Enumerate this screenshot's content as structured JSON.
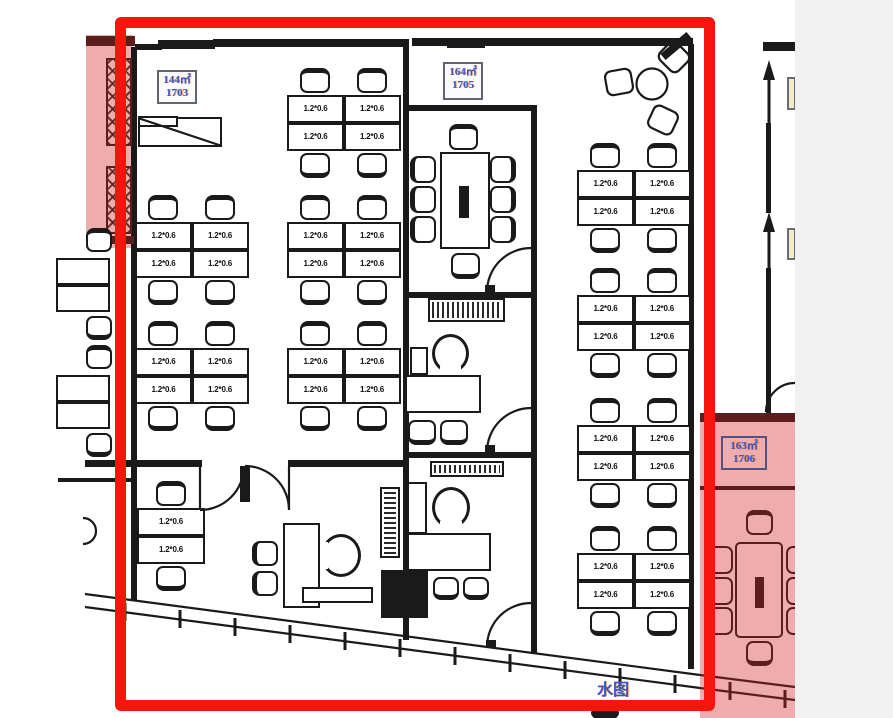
{
  "rooms": [
    {
      "area": "144㎡",
      "number": "1703",
      "highlighted": false
    },
    {
      "area": "164㎡",
      "number": "1705",
      "highlighted": false
    },
    {
      "area": "163㎡",
      "number": "1706",
      "highlighted": true
    }
  ],
  "desk_label": "1.2*0.6",
  "annotations": {
    "bottom_text": "水图"
  },
  "colors": {
    "selection_box": "#f5150c",
    "room_highlight_fill": "#eeacac",
    "highlight_line": "#5c1d1d",
    "cad_line": "#1a1a1a",
    "label_text": "#3d55bd",
    "side_background": "#f1f1f2"
  }
}
